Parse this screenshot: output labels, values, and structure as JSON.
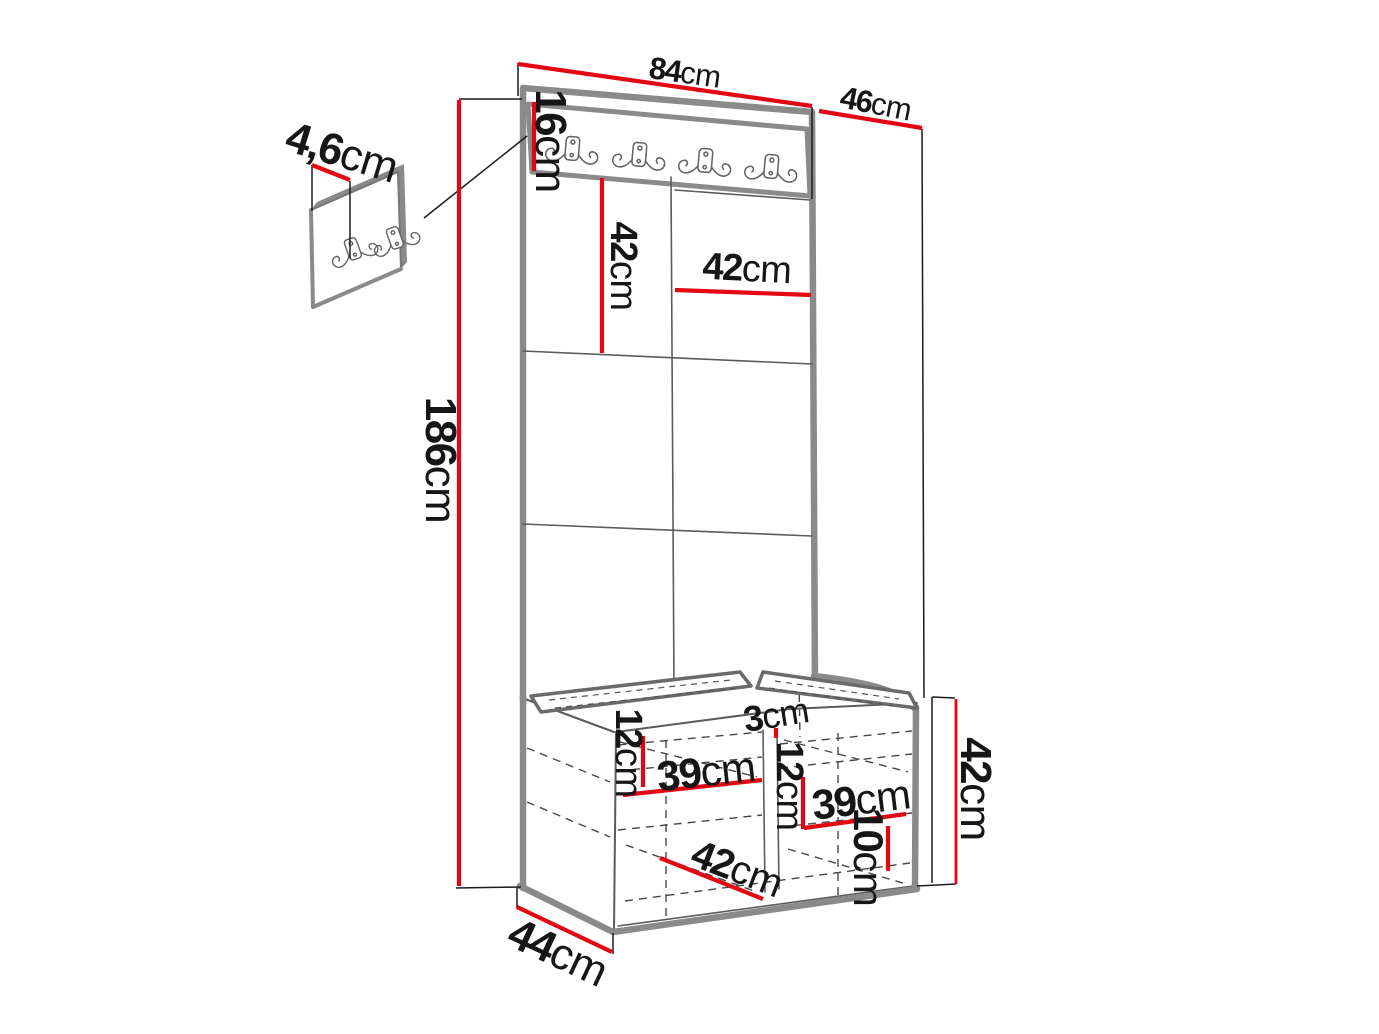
{
  "diagram": {
    "kind": "furniture dimension diagram",
    "subject": "hallway wardrobe panel with hook rail, upholstered tiles and shoe bench",
    "units": "cm"
  },
  "colors": {
    "dimension_red": "#e30613",
    "outline_grey": "#8a8a8a",
    "line_ink": "#1c1c1c",
    "text_ink": "#161616"
  },
  "dimensions": {
    "wall_panel_thickness": {
      "value": "4,6",
      "unit": "cm"
    },
    "hook_rail_height": {
      "value": "16",
      "unit": "cm"
    },
    "unit_width": {
      "value": "84",
      "unit": "cm"
    },
    "unit_depth": {
      "value": "46",
      "unit": "cm"
    },
    "panel_tile_height": {
      "value": "42",
      "unit": "cm"
    },
    "panel_tile_width": {
      "value": "42",
      "unit": "cm"
    },
    "unit_height": {
      "value": "186",
      "unit": "cm"
    },
    "bench_left_shelf_gap": {
      "value": "12",
      "unit": "cm"
    },
    "bench_left_shelf_width": {
      "value": "39",
      "unit": "cm"
    },
    "bench_divider_thickness": {
      "value": "3",
      "unit": "cm"
    },
    "bench_right_shelf_gap": {
      "value": "12",
      "unit": "cm"
    },
    "bench_right_shelf_width": {
      "value": "39",
      "unit": "cm"
    },
    "bench_floor_depth": {
      "value": "42",
      "unit": "cm"
    },
    "bench_bottom_gap": {
      "value": "10",
      "unit": "cm"
    },
    "bench_height": {
      "value": "42",
      "unit": "cm"
    },
    "bench_depth": {
      "value": "44",
      "unit": "cm"
    }
  }
}
